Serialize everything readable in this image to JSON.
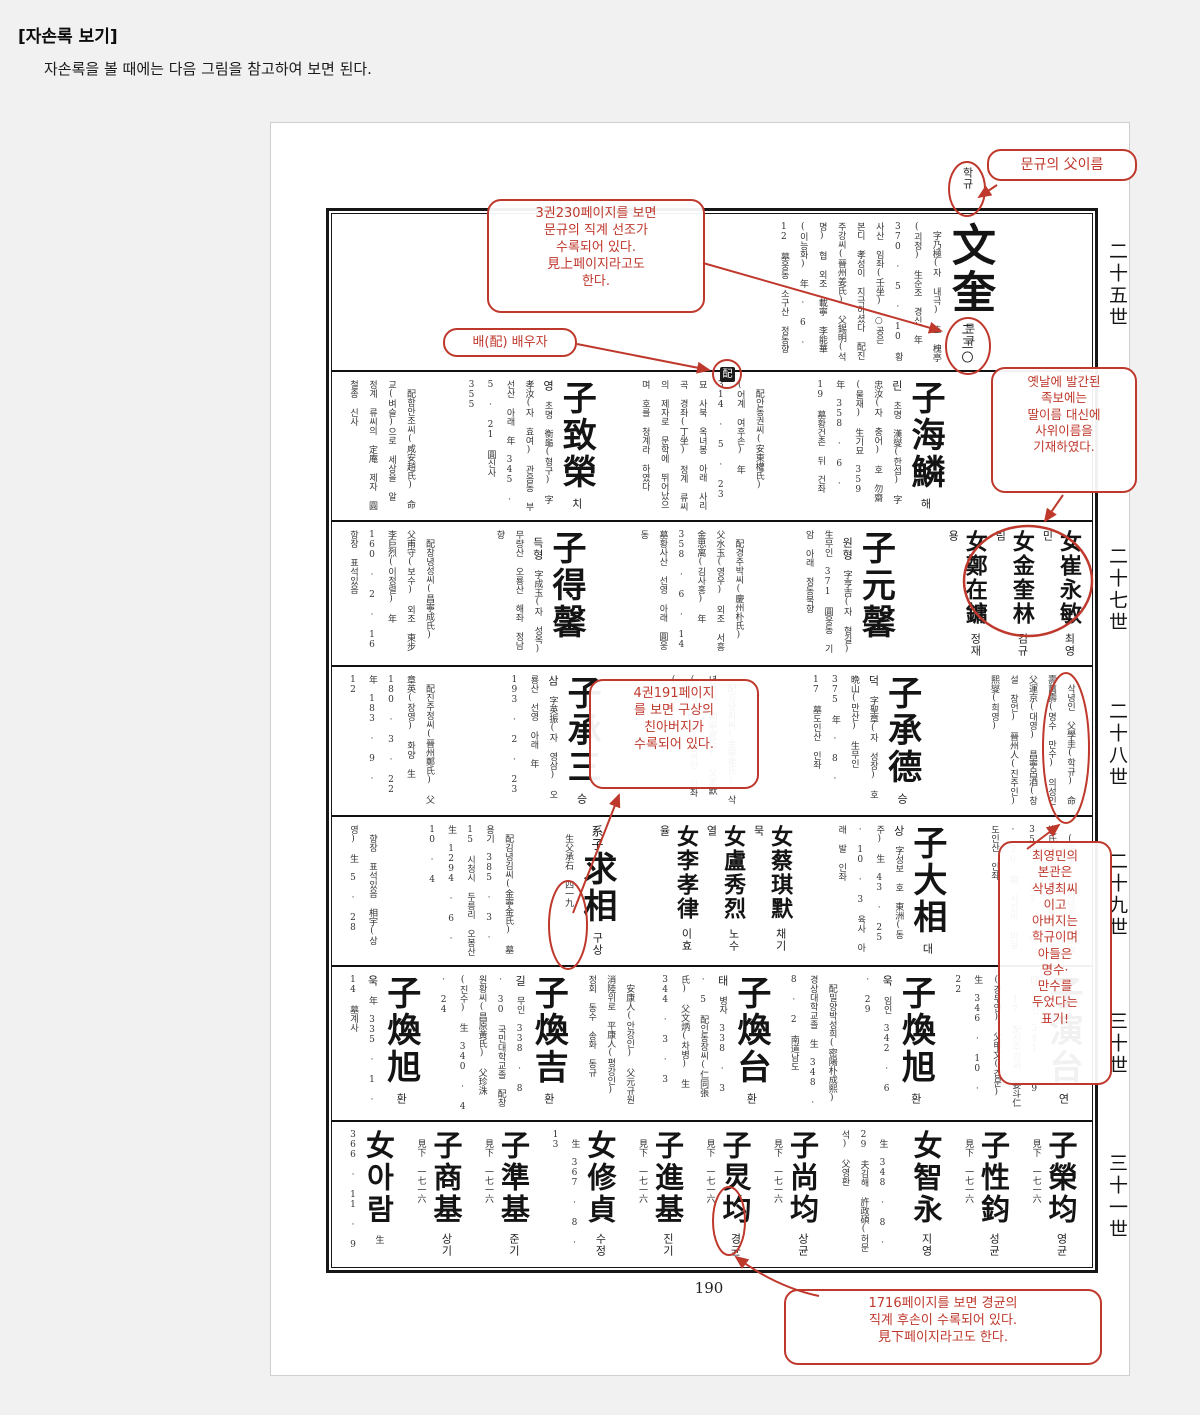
{
  "header": {
    "title": "[자손록 보기]",
    "subtitle": "자손록을 볼 때에는 다음 그림을 참고하여 보면 된다."
  },
  "page": {
    "number": "190"
  },
  "generations": [
    "二十五世",
    "二十七世",
    "二十八世",
    "二十九世",
    "三十世",
    "三十一世"
  ],
  "colors": {
    "annotation_red": "#bf382c",
    "ink": "#141414",
    "page_bg": "#f1f1f1"
  },
  "annotations": {
    "father_name": {
      "box": "문규의 父이름",
      "target": "학규"
    },
    "see_above": {
      "box": "3권230페이지를 보면\n문규의 직계 선조가\n수록되어 있다.\n見上페이지라고도\n한다.",
      "target": "二三〇"
    },
    "spouse": {
      "box": "배(配) 배우자",
      "target": "配"
    },
    "daughters": {
      "box": "옛날에 발간된\n족보에는\n딸이름 대신에\n사위이름을\n기재하였다."
    },
    "birth_father": {
      "box": "4권191페이지\n를 보면 구상의\n친아버지가\n수록되어 있다."
    },
    "choi_note": {
      "box": "최영민의\n본관은\n삭녕최씨\n이고\n아버지는\n학규이며\n아들은\n명수·\n만수를\n두었다는\n표기!"
    },
    "see_below": {
      "box": "1716페이지를 보면 경균의\n직계 후손이 수록되어 있다.\n見下페이지라고도 한다."
    }
  },
  "rows": [
    {
      "generation": "二十五世",
      "entries": [
        {
          "name": "文奎",
          "reading": "문규",
          "details": [
            "字乃極(자 내극)",
            "호 槐亭(괴정)",
            "生순조 경신",
            "年 370 · 5 · 10",
            "황사산 임좌(壬坐)",
            "○공은 본디 孝성이 지극하셨다",
            "配진주강씨(晉州姜氏)",
            "父錫明(석명) 협",
            "외조 載寧 李能華(이능화)",
            "年 · 6 · 12",
            "墓웅동 소구산 정동향"
          ]
        }
      ]
    },
    {
      "generation": "二十六世",
      "entries": [
        {
          "name": "子海鱗",
          "reading": "해린",
          "details": [
            "초명 漢燮(한섭)",
            "字忠汝(자 충어)",
            "호 勿齋(물재)",
            "生기묘 359",
            "年 358 · 6 · 19",
            "墓황건촌 뒤 건좌"
          ]
        },
        {
          "details": [
            "配안동권씨(安東權氏)",
            "(어계 여후손)",
            "年 314 · 5 · 23",
            "묘 사북 옥녀봉 아래 사리곡 경좌(丁坐)",
            "정계 류씨의 제자로 문학에 뛰어났으며 호를 청계라 하였다"
          ]
        },
        {
          "name": "子致榮",
          "reading": "치영",
          "details": [
            "초명 衡龜(형구)",
            "字孝汝(자 효여)",
            "관음동 부선산 아래",
            "年 345 · 5 · 21",
            "圓신사 355"
          ]
        },
        {
          "details": [
            "配함안조씨(咸安趙氏)",
            "命교(벼슬)으로 세상을 알",
            "정계 류씨의 定庵 제자",
            "圓철종 신사"
          ]
        }
      ]
    },
    {
      "generation": "二十七世",
      "entries": [
        {
          "group": [
            {
              "name": "女崔永敏",
              "reading": "최영민",
              "size": "md"
            },
            {
              "name": "女金奎林",
              "reading": "김규림",
              "size": "md"
            },
            {
              "name": "女鄭在鏞",
              "reading": "정재용",
              "size": "md"
            }
          ]
        },
        {
          "name": "子元馨",
          "reading": "원형",
          "details": [
            "字亨吉(자 형길)",
            "生무인 371",
            "圓웅동 기암 아래",
            "정동북향"
          ]
        },
        {
          "details": [
            "配경주박씨(慶州朴氏)",
            "父水玉(영우)",
            "외조 서흥 金思离(김사홍)",
            "年 358 · 6 · 14",
            "墓황사산 선영 아래 圓웅동"
          ]
        },
        {
          "name": "子得馨",
          "reading": "득형",
          "details": [
            "字成玉(자 성옥)",
            "무량산 오룡산 해좌",
            "정남향"
          ]
        },
        {
          "details": [
            "配창녕성씨(昌寧成氏)",
            "父甫守(보수)",
            "외조 東步 李巨烈(이정렬)",
            "年 160 · 2 · 16",
            "항장 표석있음"
          ]
        }
      ]
    },
    {
      "generation": "二十八世",
      "entries": [
        {
          "details": [
            "삭녕인 父學圭(학규)",
            "命壽萬壽(명수 만수)",
            "의성인 父運京(대영)",
            "昌寧呂酒(창설 창언)",
            "晉州人(진주인) 熙燮(희영)"
          ]
        },
        {
          "name": "子承德",
          "reading": "승덕",
          "details": [
            "字聖章(자 성장)",
            "호 晩山(만산)",
            "生무인 375",
            "年 · 8 · 17",
            "墓도인산 인좌"
          ]
        },
        {
          "details": [
            "配김녕최씨(金寧崔氏)",
            "삭녕최씨(朔寧崔氏)",
            "父定默(정묵)",
            "墓 대국산 임좌(壬坐)"
          ]
        },
        {
          "name": "子承三",
          "reading": "승삼",
          "details": [
            "字英振(자 영삼)",
            "오룡산 선영 아래",
            "年 193 · 2 · 23"
          ]
        },
        {
          "details": [
            "配진주정씨(晉州鄭氏)",
            "父章英(장영) 화양",
            "生 180 · 3 · 22",
            "年 183 · 9 · 12"
          ]
        }
      ]
    },
    {
      "generation": "二十九世",
      "entries": [
        {
          "details": [
            "(寅生)",
            "配삭녕최씨(朔寧崔氏)",
            "父白淳(백순)",
            "年 350 · 23 · 9 · 30",
            "墓 사갑박 비달 도인산 인좌"
          ]
        },
        {
          "name": "子大相",
          "reading": "대상",
          "details": [
            "字성보 호 東洲(동주)",
            "生 43 · 25 · 10 · 3",
            "육사 아래 발 인좌"
          ]
        },
        {
          "group": [
            {
              "name": "女蔡琪默",
              "reading": "채기묵",
              "size": "md"
            },
            {
              "name": "女盧秀烈",
              "reading": "노수열",
              "size": "md"
            },
            {
              "name": "女李孝律",
              "reading": "이효율",
              "size": "md"
            }
          ]
        },
        {
          "name": "求相",
          "reading": "구상",
          "prefix": "系子",
          "details": [
            "生父承石",
            "四一九"
          ]
        },
        {
          "details": [
            "配김녕김씨(金寧金氏)",
            "墓 용기 385 · 3 · 15",
            "시청시 두릉리 오봉산",
            "生 1294 · 6 · 10 · 4"
          ]
        },
        {
          "details": [
            "향장 표석있음",
            "相宇(상영)",
            "生 5 · 28"
          ]
        }
      ]
    },
    {
      "generation": "三十世",
      "entries": [
        {
          "name": "子演台",
          "reading": "연대",
          "details": [
            "갑진 341 · 9 · 17",
            "配진주강씨 姜斗仁(강두인)",
            "父甲文(갑문)",
            "生 346 · 10 · 22"
          ]
        },
        {
          "name": "子煥旭",
          "reading": "환욱",
          "details": [
            "임인 342 · 6 · 29"
          ]
        },
        {
          "details": [
            "配밀양박성희(密陽朴成熙)",
            "경상대학교졸",
            "生 348 · 8 · 2 南道남도"
          ]
        },
        {
          "name": "子煥台",
          "reading": "환태",
          "details": [
            "병자 338 · 3 · 5",
            "配인동장씨(仁同張氏)",
            "父文炳(차병)",
            "生 344 · 3 · 3"
          ]
        },
        {
          "details": [
            "安康人(안강인) 父元규원",
            "消陸위로 平康人(평강인)",
            "정회 동수 송화 동규"
          ]
        },
        {
          "name": "子煥吉",
          "reading": "환길",
          "details": [
            "무인 338 · 8 · 30",
            "국민대학교졸",
            "配창원황씨(昌原黃氏)",
            "父珍洙(진수)",
            "生 340 · 4 · 24"
          ]
        },
        {
          "name": "子煥旭",
          "reading": "환욱",
          "details": [
            "年 335 · 1 · 14",
            "墓계사"
          ]
        }
      ]
    },
    {
      "generation": "三十一世",
      "entries": [
        {
          "name": "子榮均",
          "reading": "영균",
          "details": [
            "見下 一七一六"
          ]
        },
        {
          "name": "子性鈞",
          "reading": "성균",
          "details": [
            "見下 一七一六"
          ]
        },
        {
          "name": "女智永",
          "reading": "지영"
        },
        {
          "details": [
            "生 348 · 8 · 29",
            "夫김해 許政碩(허문석)",
            "父영환"
          ]
        },
        {
          "name": "子尚均",
          "reading": "상균",
          "details": [
            "見下 一七一六"
          ]
        },
        {
          "name": "子炅均",
          "reading": "경균",
          "details": [
            "見下 一七一六"
          ]
        },
        {
          "name": "子進基",
          "reading": "진기",
          "details": [
            "見下 一七一六"
          ]
        },
        {
          "name": "女修貞",
          "reading": "수정",
          "details": [
            "生 367 · 8 · 13"
          ]
        },
        {
          "name": "子準基",
          "reading": "준기",
          "details": [
            "見下 一七一六"
          ]
        },
        {
          "name": "子商基",
          "reading": "상기",
          "details": [
            "見下 一七一六"
          ]
        },
        {
          "name": "女아람",
          "details": [
            "生 366 · 11 · 9"
          ]
        }
      ]
    }
  ]
}
